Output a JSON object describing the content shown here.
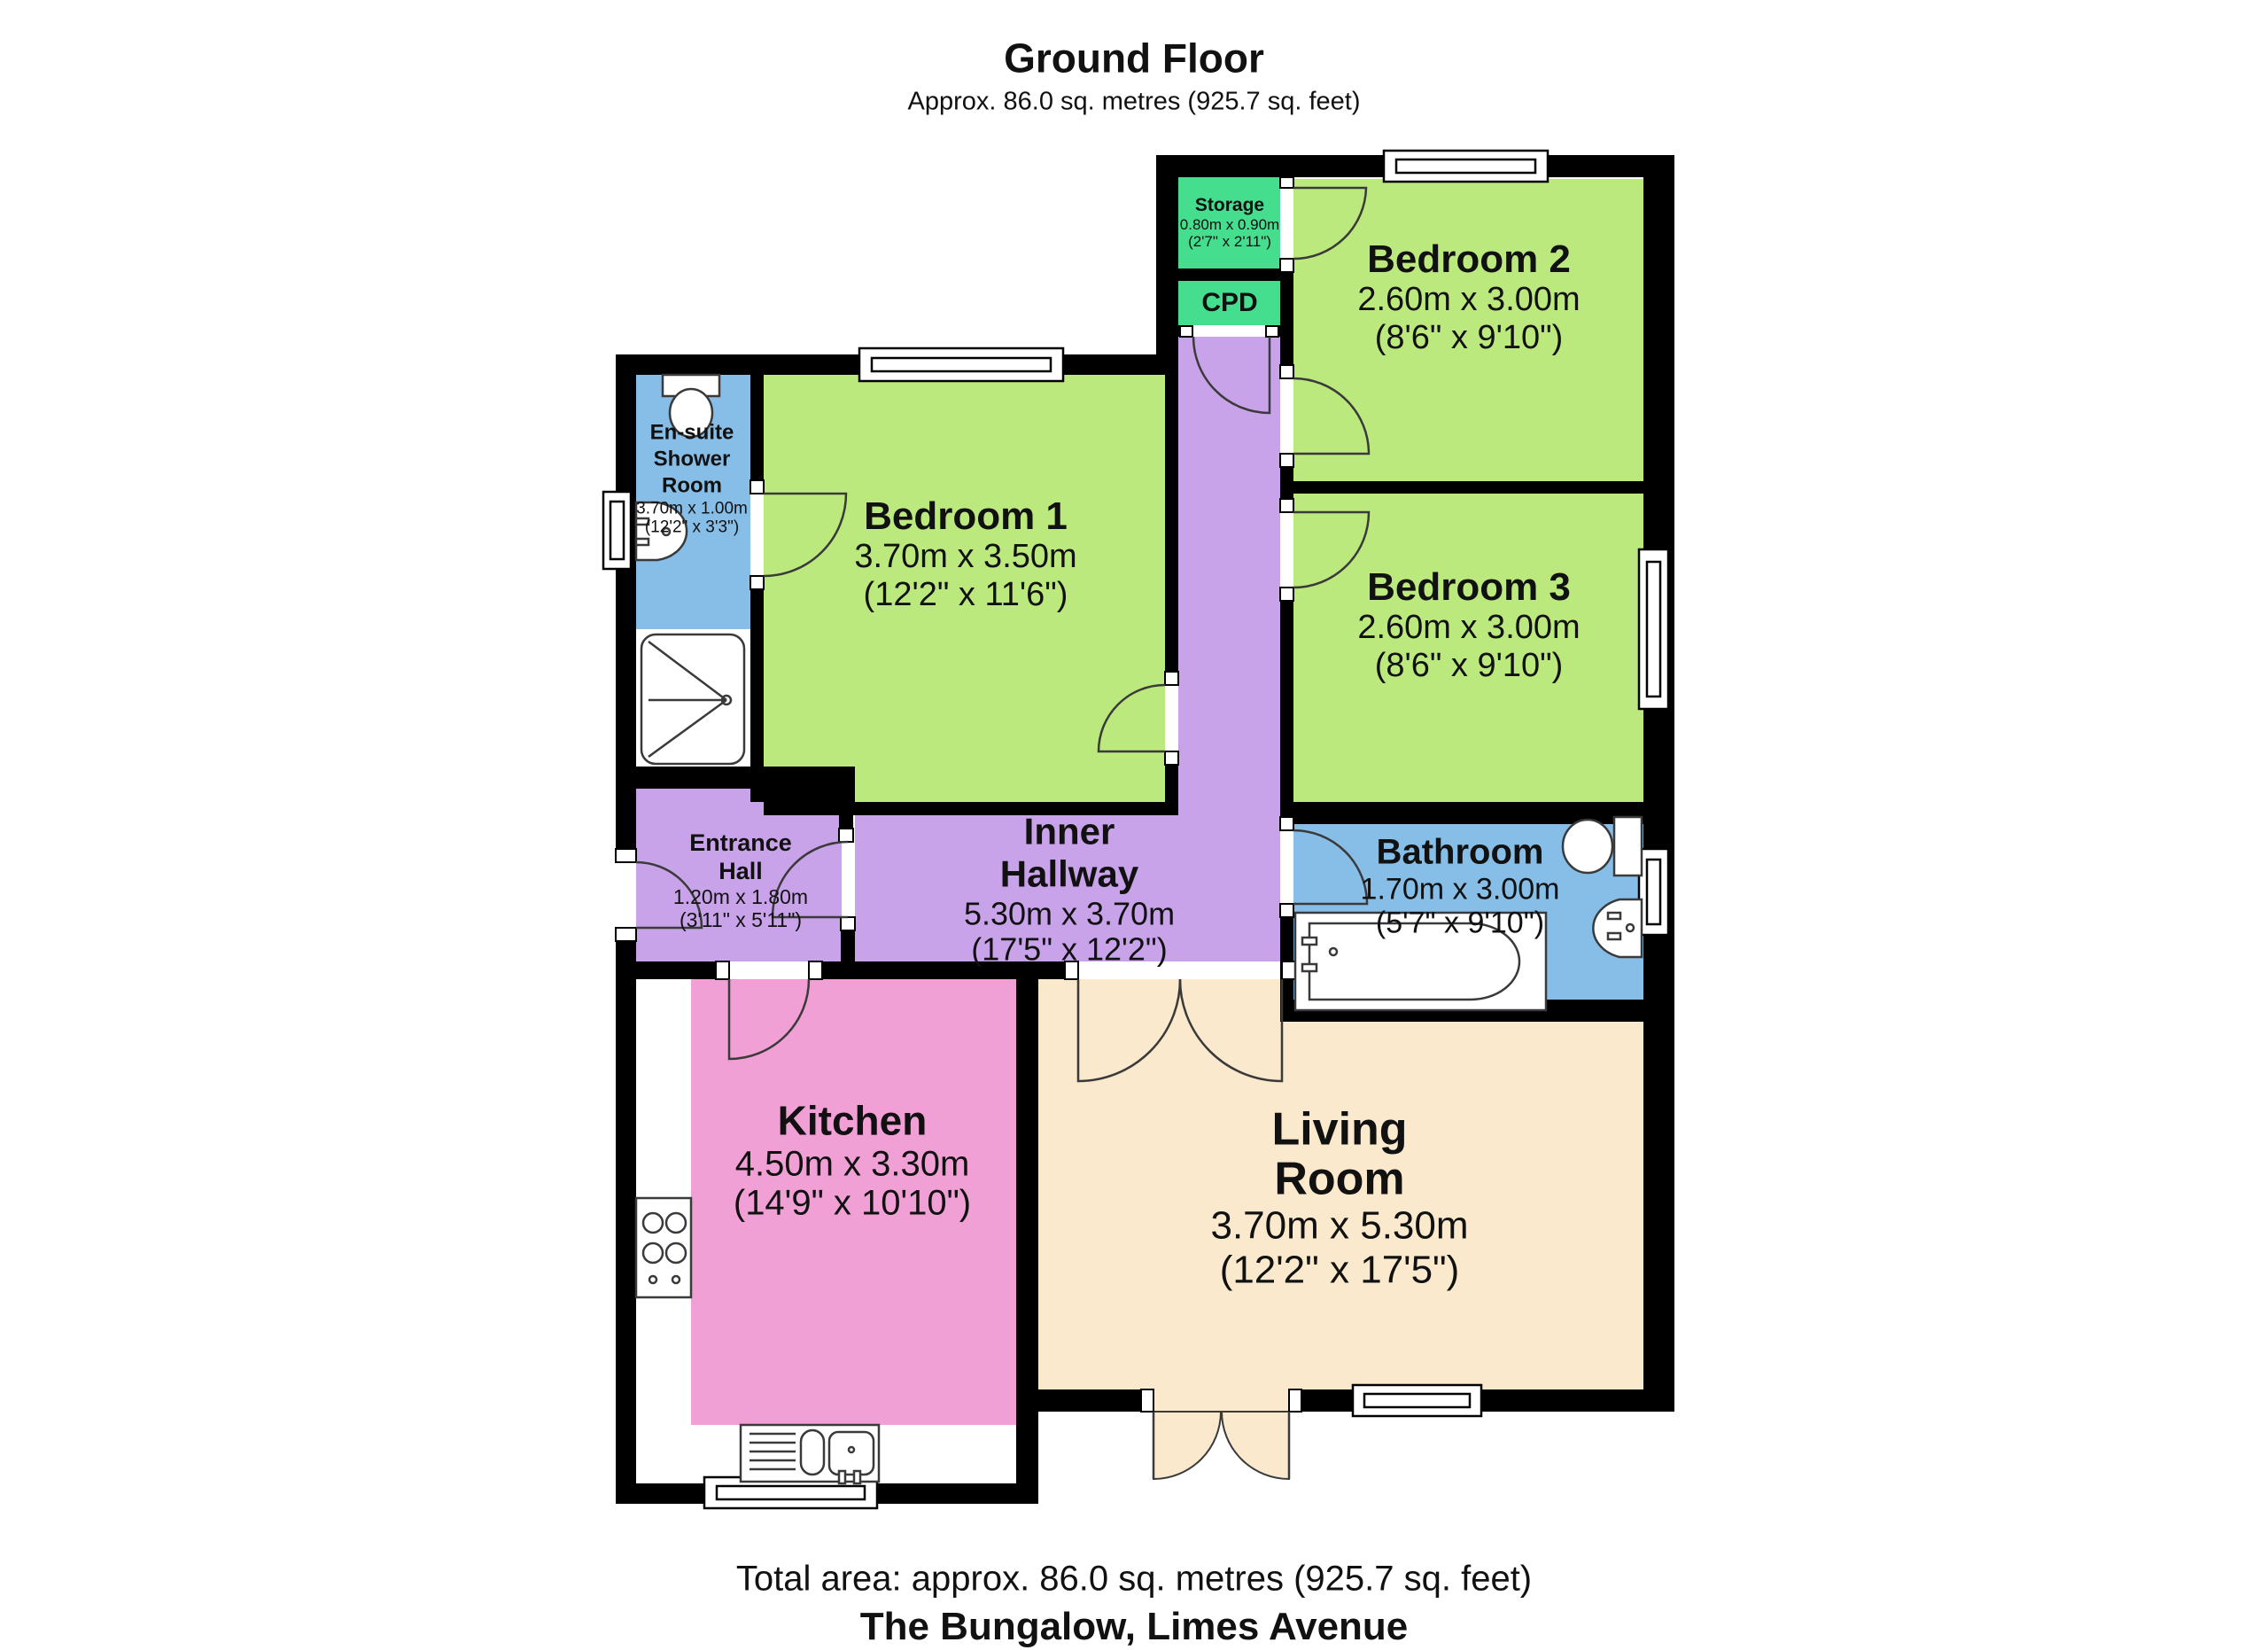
{
  "title": {
    "heading": "Ground Floor",
    "subtitle": "Approx. 86.0 sq. metres (925.7 sq. feet)"
  },
  "footer": {
    "total_area": "Total area: approx. 86.0 sq. metres (925.7 sq. feet)",
    "address": "The Bungalow, Limes Avenue"
  },
  "colors": {
    "wall": "#000000",
    "bedroom_green": "#bce97d",
    "storage_green": "#45dd8e",
    "hallway_purple": "#c9a3ea",
    "bathroom_blue": "#87bee7",
    "kitchen_pink": "#f0a0d5",
    "living_cream": "#fae9cc",
    "fixture_white": "#ffffff",
    "line": "#3a3a3a"
  },
  "rooms": {
    "storage": {
      "name": "Storage",
      "dims_m": "0.80m x 0.90m",
      "dims_ft": "(2'7\" x 2'11\")"
    },
    "cpd": {
      "name": "CPD"
    },
    "bedroom2": {
      "name": "Bedroom 2",
      "dims_m": "2.60m x 3.00m",
      "dims_ft": "(8'6\" x 9'10\")"
    },
    "bedroom1": {
      "name": "Bedroom 1",
      "dims_m": "3.70m x 3.50m",
      "dims_ft": "(12'2\" x 11'6\")"
    },
    "bedroom3": {
      "name": "Bedroom 3",
      "dims_m": "2.60m x 3.00m",
      "dims_ft": "(8'6\" x 9'10\")"
    },
    "bathroom": {
      "name": "Bathroom",
      "dims_m": "1.70m x 3.00m",
      "dims_ft": "(5'7\" x 9'10\")"
    },
    "ensuite": {
      "name_lines": [
        "En-suite",
        "Shower",
        "Room"
      ],
      "dims_m": "3.70m x 1.00m",
      "dims_ft": "(12'2\" x 3'3\")"
    },
    "entrance_hall": {
      "name_lines": [
        "Entrance",
        "Hall"
      ],
      "dims_m": "1.20m x 1.80m",
      "dims_ft": "(3'11\" x 5'11\")"
    },
    "inner_hallway": {
      "name_lines": [
        "Inner",
        "Hallway"
      ],
      "dims_m": "5.30m x 3.70m",
      "dims_ft": "(17'5\" x 12'2\")"
    },
    "kitchen": {
      "name": "Kitchen",
      "dims_m": "4.50m x 3.30m",
      "dims_ft": "(14'9\" x 10'10\")"
    },
    "living_room": {
      "name_lines": [
        "Living",
        "Room"
      ],
      "dims_m": "3.70m x 5.30m",
      "dims_ft": "(12'2\" x 17'5\")"
    }
  }
}
